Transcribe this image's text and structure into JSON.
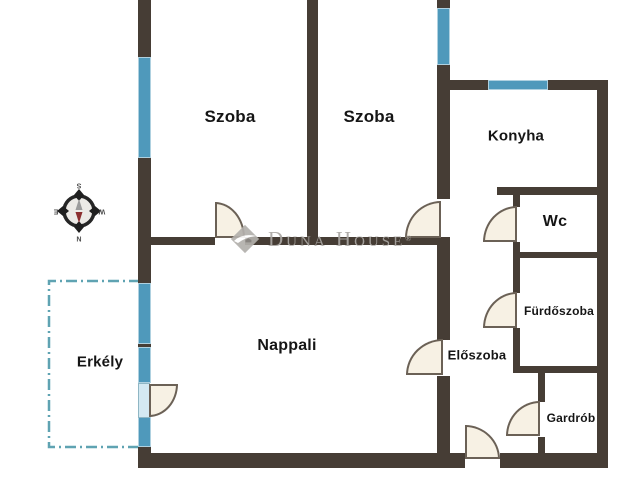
{
  "title": "Apartment floor plan",
  "colors": {
    "wall": "#463d35",
    "window_fill": "#4f99bb",
    "door_fill": "#f7f1e4",
    "door_line": "#6b6156",
    "balcony_dash": "#5fa3b2",
    "label": "#151515",
    "watermark": "#aaa7a3",
    "needle_north": "#8c2f2f",
    "needle_south": "#9b9b9b"
  },
  "rooms": {
    "szoba1": {
      "label": "Szoba"
    },
    "szoba2": {
      "label": "Szoba"
    },
    "konyha": {
      "label": "Konyha"
    },
    "wc": {
      "label": "Wc"
    },
    "furdoszoba": {
      "label": "Fürdőszoba"
    },
    "eloszoba": {
      "label": "Előszoba"
    },
    "nappali": {
      "label": "Nappali"
    },
    "gardrob": {
      "label": "Gardrób"
    },
    "erkely": {
      "label": "Erkély"
    }
  },
  "compass": {
    "top": "S",
    "right": "W",
    "bottom": "N",
    "left": "E"
  },
  "watermark": {
    "brand": "Duna House",
    "registered": "®"
  }
}
